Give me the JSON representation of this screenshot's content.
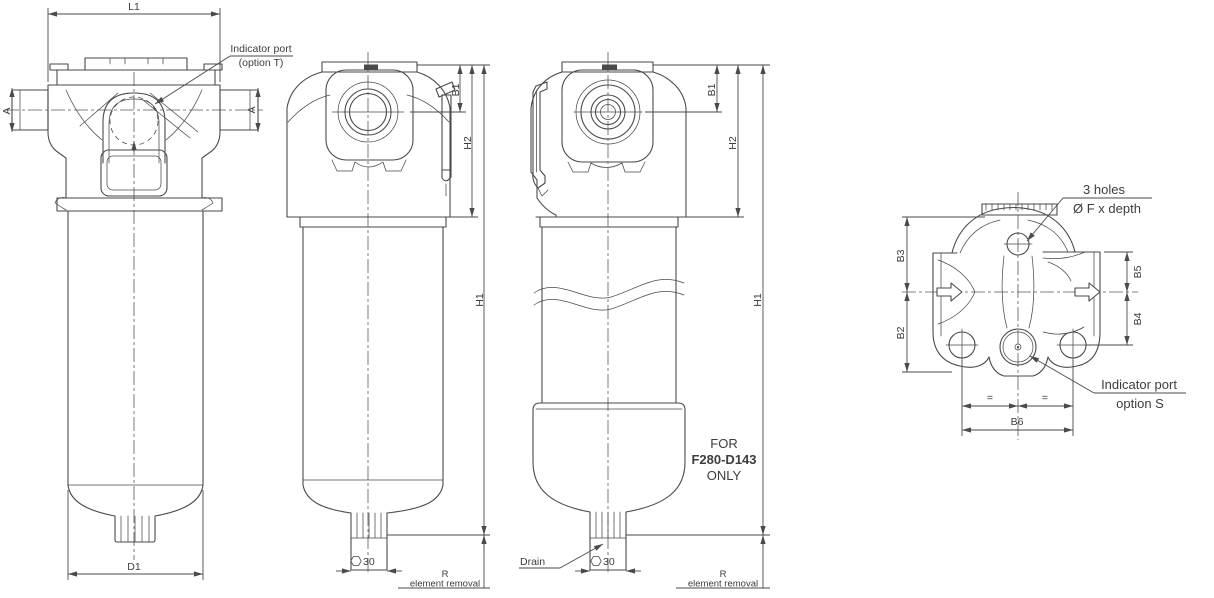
{
  "colors": {
    "background": "#ffffff",
    "line": "#4a4a4a",
    "text": "#3d3d3d"
  },
  "section_view": {
    "dim_width": "L1",
    "dim_diameter": "D1",
    "section_marker_left": "A",
    "section_marker_right": "A",
    "indicator_callout_line1": "Indicator port",
    "indicator_callout_line2": "(option T)"
  },
  "front_view": {
    "dim_port_height": "B1",
    "dim_head_height": "H2",
    "dim_total_height": "H1",
    "hex_size": "30",
    "removal_line1": "R",
    "removal_line2": "element removal"
  },
  "side_view": {
    "dim_port_height": "B1",
    "dim_head_height": "H2",
    "dim_total_height": "H1",
    "hex_size": "30",
    "drain_label": "Drain",
    "note_line1": "FOR",
    "note_line2": "F280-D143",
    "note_line3": "ONLY",
    "removal_line1": "R",
    "removal_line2": "element removal"
  },
  "top_view": {
    "holes_callout_line1": "3 holes",
    "holes_callout_line2": "Ø F x depth",
    "dim_b3": "B3",
    "dim_b2": "B2",
    "dim_b5": "B5",
    "dim_b4": "B4",
    "dim_b6": "B6",
    "equal_left": "=",
    "equal_right": "=",
    "indicator_callout_line1": "Indicator port",
    "indicator_callout_line2": "option S"
  }
}
